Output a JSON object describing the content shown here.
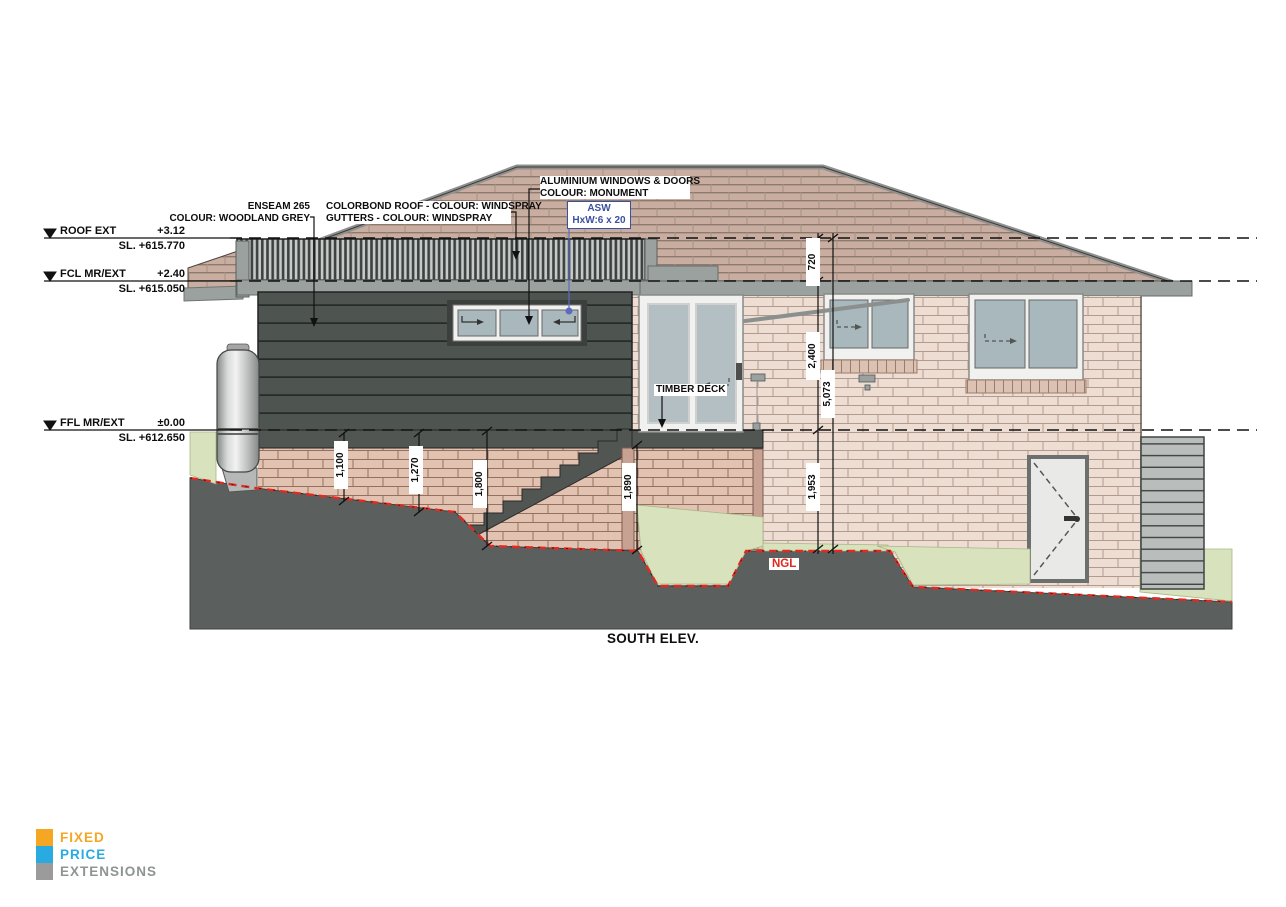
{
  "title": "SOUTH ELEV.",
  "levels": [
    {
      "label": "ROOF EXT",
      "value": "+3.12",
      "sl": "SL. +615.770"
    },
    {
      "label": "FCL MR/EXT",
      "value": "+2.40",
      "sl": "SL. +615.050"
    },
    {
      "label": "FFL MR/EXT",
      "value": "±0.00",
      "sl": "SL. +612.650"
    }
  ],
  "annotations": {
    "enseam_line1": "ENSEAM 265",
    "enseam_line2": "COLOUR: WOODLAND GREY",
    "colorbond_line1": "COLORBOND ROOF - COLOUR: WINDSPRAY",
    "colorbond_line2": "GUTTERS - COLOUR: WINDSPRAY",
    "aluminium_line1": "ALUMINIUM WINDOWS & DOORS",
    "aluminium_line2": "COLOUR: MONUMENT",
    "asw_line1": "ASW",
    "asw_line2": "HxW:6 x 20",
    "timber_deck": "TIMBER DECK",
    "ngl": "NGL"
  },
  "dimensions": {
    "roof_to_fcl": "720",
    "fcl_to_ffl": "2,400",
    "total_height": "5,073",
    "ffl_to_ngl": "1,953",
    "stair_1": "1,100",
    "stair_2": "1,270",
    "stair_3": "1,800",
    "stair_4": "1,890"
  },
  "logo": {
    "line1": "FIXED",
    "line2": "PRICE",
    "line3": "EXTENSIONS"
  },
  "colors": {
    "logo_orange": "#F5A623",
    "logo_blue": "#29ABE2",
    "logo_grey": "#9B9B9B",
    "ngl_red": "#E0281E",
    "asw_blue": "#3C50A2",
    "cladding_dark": "#4E5450",
    "brick_light": "#EDDDD3",
    "brick_lower": "#E2C3B1",
    "roof_tile": "#C9ADA0",
    "fascia_grey": "#9AA19F"
  }
}
